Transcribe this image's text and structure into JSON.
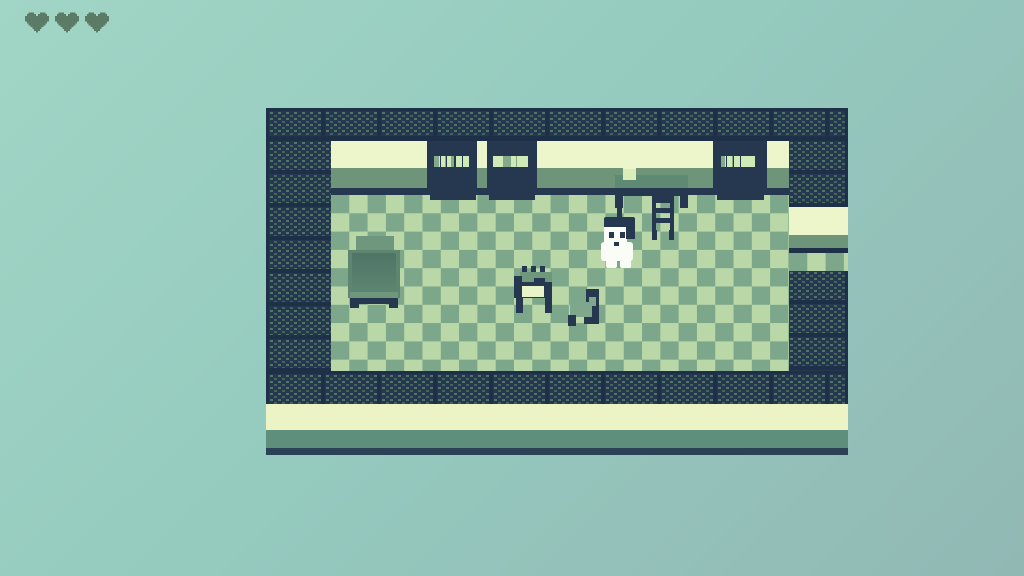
{
  "app": {
    "name": "pixel-rpg-room-scene"
  },
  "hud": {
    "hearts": 3,
    "heart_color": "#5c7b66"
  },
  "palette": {
    "bg_top": "#a1d5c5",
    "bg_mid": "#95cbbf",
    "bg_bottom": "#92b8b4",
    "navy": "#25384f",
    "navy_deep": "#1e3047",
    "navy_line": "#2a4156",
    "tile_dot": "#527567",
    "tile_dot2": "#44655e",
    "cream": "#edf5cb",
    "cream2": "#ecf4c6",
    "band_green": "#6e9579",
    "band_green2": "#5e8f7d",
    "floor_light": "#bad8a7",
    "floor_mid": "#7ca78b",
    "book_light": "#cfeab6",
    "book_mid": "#84aa8c",
    "desk_green": "#5e8a74",
    "bench_green": "#6f977c",
    "seat_green": "#7fa78b",
    "bed_green": "#5d8570",
    "bed_dark": "#4e7466",
    "bed_pillow": "#6f977e",
    "panel_cream": "#e9f3c8",
    "lamp_mid": "#d9ecba",
    "sprite_white": "#fafdf5",
    "heart": "#5c7b66"
  },
  "scene": {
    "room": {
      "walls": "navy brick tiles",
      "floor": "green checkerboard",
      "doorway": "right wall opening"
    },
    "entities": [
      "bookshelf-left-1",
      "bookshelf-left-2",
      "bookshelf-right",
      "desk",
      "desk-lamp",
      "desk-chair",
      "bed",
      "workbench",
      "chair",
      "player-character"
    ],
    "bookshelves": [
      {
        "rows": [
          [
            "l:5",
            "g:2",
            "l:4",
            "g:2",
            "m:7",
            "g:2",
            "l:4",
            "g:3",
            "l:6"
          ],
          [
            "l:6",
            "g:2",
            "m:4",
            "g:2",
            "m:4",
            "g:6",
            "l:4",
            "g:2",
            "l:5"
          ],
          [
            "m:5",
            "g:2",
            "l:4",
            "g:2",
            "l:4",
            "g:5",
            "l:5",
            "g:2",
            "l:6"
          ]
        ]
      },
      {
        "rows": [
          [
            "l:4",
            "g:2",
            "l:4",
            "g:2",
            "m:6",
            "g:3",
            "l:4",
            "g:2",
            "l:7"
          ],
          [
            "l:6",
            "g:2",
            "l:4",
            "g:2",
            "m:5",
            "g:4",
            "m:4",
            "g:2",
            "l:4"
          ],
          [
            "g:3",
            "l:5",
            "g:2",
            "m:6",
            "g:2",
            "l:4",
            "g:2",
            "l:5",
            "g:2",
            "l:4"
          ]
        ]
      },
      {
        "rows": [
          [
            "l:5",
            "g:2",
            "m:5",
            "g:2",
            "l:4",
            "g:2",
            "l:4",
            "g:3",
            "l:6"
          ],
          [
            "l:4",
            "g:2",
            "m:6",
            "g:2",
            "l:5",
            "g:4",
            "l:4",
            "g:2",
            "l:5"
          ],
          [
            "m:4",
            "g:2",
            "l:5",
            "g:2",
            "l:4",
            "g:4",
            "l:6",
            "g:2",
            "l:4"
          ]
        ]
      }
    ]
  }
}
